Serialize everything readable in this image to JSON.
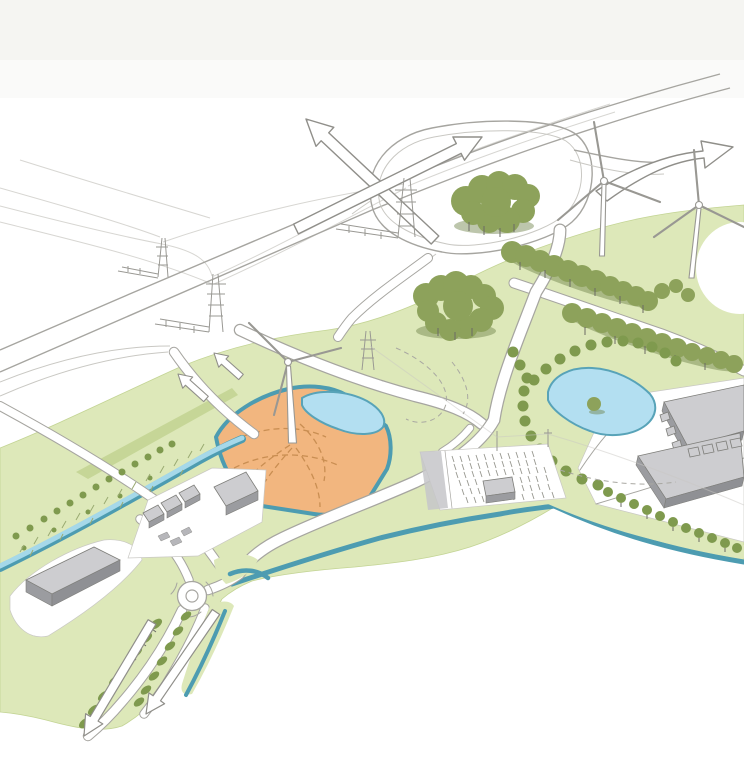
{
  "colors": {
    "background": "#ffffff",
    "top_wash": "#f3f2ef",
    "field": "#dde8b9",
    "field_edge": "#c3d494",
    "field_accent": "#c6d697",
    "tree": "#8da25b",
    "tree_small": "#7f9a4e",
    "tree_dark": "#6d8048",
    "trunk": "#6a6a64",
    "orange_site": "#f2b67f",
    "orange_dash": "#c98e52",
    "pond": "#b3dff1",
    "pond_edge": "#58a3b8",
    "canal": "#4d9cb1",
    "canal_light": "#a5d8e9",
    "road_casing": "#a6a5a0",
    "road_fill": "#ffffff",
    "building_top": "#cdcdd0",
    "building_side": "#9b9ca0",
    "building_side2": "#8f9094",
    "building_outline": "#7e7e7a",
    "sketch": "#999893",
    "sketch_faint": "#c9c8c3",
    "arrow_stroke": "#908f8a"
  },
  "scene": {
    "description": "Hand-drawn isometric landscape concept sketch: a highway interchange with wind turbines and power pylons, a tree-belted business park with warehouses, a parking field, ponds and canals, and a development plot highlighted in orange with its own pond and wind turbine; outline arrows indicate traffic directions.",
    "wind_turbine_count": 3,
    "electricity_pylon_count": 4,
    "pond_count": 2,
    "roundabout_count": 1,
    "large_warehouse_count": 3,
    "highlighted_site": {
      "color_name": "orange",
      "has_pond": true,
      "has_wind_turbine": true
    },
    "direction_arrows": [
      {
        "id": "arrow-up-left",
        "direction": "up-left",
        "size": "large"
      },
      {
        "id": "arrow-up-right",
        "direction": "up-right",
        "size": "large"
      },
      {
        "id": "arrow-right-curved",
        "direction": "up-right",
        "size": "large"
      },
      {
        "id": "ramp-arrow-1",
        "direction": "up-left",
        "size": "small"
      },
      {
        "id": "ramp-arrow-2",
        "direction": "up-left",
        "size": "small"
      },
      {
        "id": "south-arrow-1",
        "direction": "down-left",
        "size": "medium"
      },
      {
        "id": "south-arrow-2",
        "direction": "down-left",
        "size": "medium"
      }
    ]
  }
}
